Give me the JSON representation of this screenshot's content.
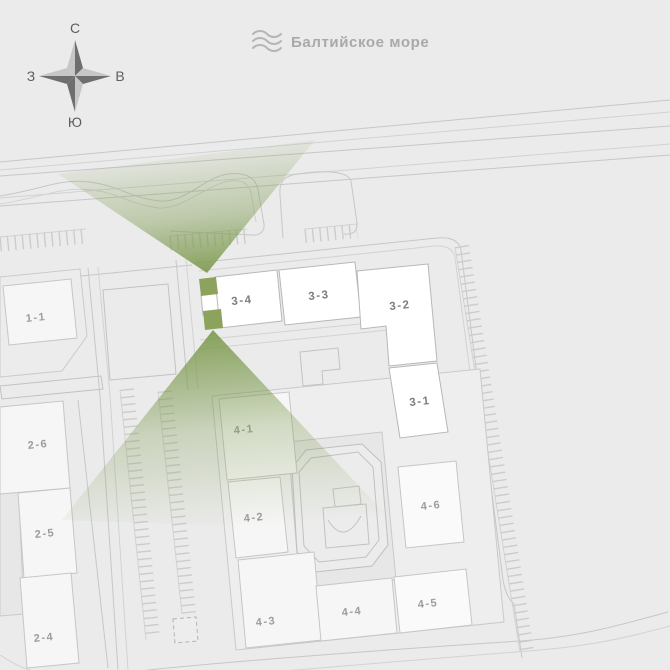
{
  "compass": {
    "north": "С",
    "east": "В",
    "south": "Ю",
    "west": "З"
  },
  "sea": {
    "label": "Балтийское море"
  },
  "buildings": {
    "b1_1": "1-1",
    "b2_6": "2-6",
    "b2_5": "2-5",
    "b2_4": "2-4",
    "b3_4": "3-4",
    "b3_3": "3-3",
    "b3_2": "3-2",
    "b3_1": "3-1",
    "b4_1": "4-1",
    "b4_2": "4-2",
    "b4_3": "4-3",
    "b4_4": "4-4",
    "b4_5": "4-5",
    "b4_6": "4-6"
  },
  "colors": {
    "background": "#ebebeb",
    "accent_green": "#8ca25d",
    "cone_green": "#7d9a4f",
    "line_gray": "#c7c7c7",
    "label_gray": "#9c9c9c"
  }
}
